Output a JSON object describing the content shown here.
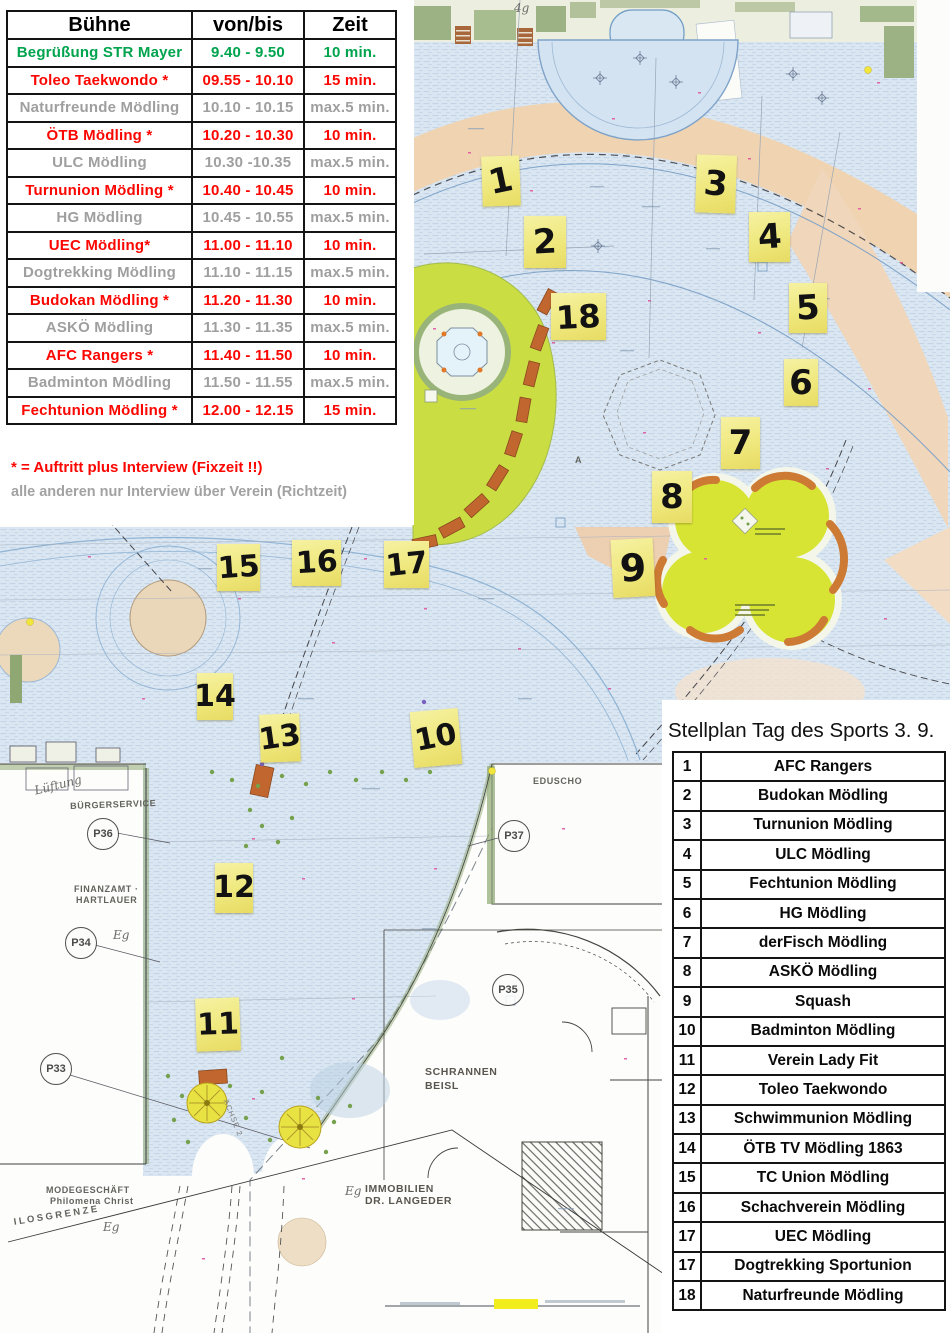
{
  "schedule": {
    "headers": [
      "Bühne",
      "von/bis",
      "Zeit"
    ],
    "rows": [
      {
        "name": "Begrüßung STR Mayer",
        "time": "9.40 - 9.50",
        "dur": "10 min.",
        "c": "green"
      },
      {
        "name": "Toleo Taekwondo *",
        "time": "09.55 - 10.10",
        "dur": "15 min.",
        "c": "red"
      },
      {
        "name": "Naturfreunde Mödling",
        "time": "10.10 - 10.15",
        "dur": "max.5 min.",
        "c": "gray"
      },
      {
        "name": "ÖTB Mödling *",
        "time": "10.20 - 10.30",
        "dur": "10 min.",
        "c": "red"
      },
      {
        "name": "ULC Mödling",
        "time": "10.30 -10.35",
        "dur": "max.5 min.",
        "c": "gray"
      },
      {
        "name": "Turnunion Mödling *",
        "time": "10.40 - 10.45",
        "dur": "10 min.",
        "c": "red"
      },
      {
        "name": "HG Mödling",
        "time": "10.45 - 10.55",
        "dur": "max.5 min.",
        "c": "gray"
      },
      {
        "name": "UEC Mödling*",
        "time": "11.00 - 11.10",
        "dur": "10 min.",
        "c": "red"
      },
      {
        "name": "Dogtrekking Mödling",
        "time": "11.10 - 11.15",
        "dur": "max.5 min.",
        "c": "gray"
      },
      {
        "name": "Budokan Mödling *",
        "time": "11.20 - 11.30",
        "dur": "10 min.",
        "c": "red"
      },
      {
        "name": "ASKÖ Mödling",
        "time": "11.30 - 11.35",
        "dur": "max.5 min.",
        "c": "gray"
      },
      {
        "name": "AFC Rangers *",
        "time": "11.40 - 11.50",
        "dur": "10 min.",
        "c": "red"
      },
      {
        "name": "Badminton Mödling",
        "time": "11.50 - 11.55",
        "dur": "max.5 min.",
        "c": "gray"
      },
      {
        "name": "Fechtunion Mödling *",
        "time": "12.00 - 12.15",
        "dur": "15 min.",
        "c": "red"
      }
    ],
    "footnote_red": "* = Auftritt plus Interview (Fixzeit !!)",
    "footnote_gray": "alle anderen nur Interview über Verein (Richtzeit)"
  },
  "stellplan": {
    "title": "Stellplan Tag des Sports  3. 9.",
    "rows": [
      {
        "num": "1",
        "name": "AFC Rangers"
      },
      {
        "num": "2",
        "name": "Budokan Mödling"
      },
      {
        "num": "3",
        "name": "Turnunion Mödling"
      },
      {
        "num": "4",
        "name": "ULC Mödling"
      },
      {
        "num": "5",
        "name": "Fechtunion Mödling"
      },
      {
        "num": "6",
        "name": "HG Mödling"
      },
      {
        "num": "7",
        "name": "derFisch Mödling"
      },
      {
        "num": "8",
        "name": "ASKÖ Mödling"
      },
      {
        "num": "9",
        "name": "Squash"
      },
      {
        "num": "10",
        "name": "Badminton Mödling"
      },
      {
        "num": "11",
        "name": "Verein Lady Fit"
      },
      {
        "num": "12",
        "name": "Toleo Taekwondo"
      },
      {
        "num": "13",
        "name": "Schwimmunion Mödling"
      },
      {
        "num": "14",
        "name": "ÖTB TV Mödling 1863"
      },
      {
        "num": "15",
        "name": "TC Union Mödling"
      },
      {
        "num": "16",
        "name": "Schachverein Mödling"
      },
      {
        "num": "17",
        "name": "UEC Mödling"
      },
      {
        "num": "17",
        "name": "Dogtrekking Sportunion"
      },
      {
        "num": "18",
        "name": "Naturfreunde Mödling"
      }
    ]
  },
  "map": {
    "colors": {
      "note_yellow": "#f1ea7f",
      "paving_blue": "#dae6f1",
      "path_peach": "#f0d4b2",
      "lawn_green": "#cadd42",
      "playground_green": "#d7e434",
      "brick_orange": "#c1662e",
      "accent_green": "#00a44e",
      "accent_red": "#fb0600",
      "accent_gray": "#9f9f9f"
    },
    "notes": [
      {
        "n": "1",
        "x": 482,
        "y": 156,
        "w": 38,
        "h": 50,
        "tilt": -2,
        "r": -10
      },
      {
        "n": "2",
        "x": 524,
        "y": 216,
        "w": 42,
        "h": 52,
        "tilt": 0,
        "r": -3
      },
      {
        "n": "3",
        "x": 696,
        "y": 155,
        "w": 40,
        "h": 58,
        "tilt": 2,
        "r": 4
      },
      {
        "n": "4",
        "x": 749,
        "y": 212,
        "w": 41,
        "h": 50,
        "tilt": 0,
        "r": -4
      },
      {
        "n": "5",
        "x": 789,
        "y": 283,
        "w": 38,
        "h": 50,
        "tilt": 0,
        "r": -3
      },
      {
        "n": "6",
        "x": 784,
        "y": 359,
        "w": 34,
        "h": 47,
        "tilt": 0,
        "r": 0
      },
      {
        "n": "7",
        "x": 721,
        "y": 417,
        "w": 39,
        "h": 52,
        "tilt": 0,
        "r": 0
      },
      {
        "n": "8",
        "x": 652,
        "y": 471,
        "w": 40,
        "h": 52,
        "tilt": 0,
        "r": 0
      },
      {
        "n": "9",
        "x": 612,
        "y": 539,
        "w": 42,
        "h": 58,
        "tilt": -3,
        "r": 0,
        "fs": 38
      },
      {
        "n": "10",
        "x": 412,
        "y": 710,
        "w": 48,
        "h": 56,
        "tilt": -5,
        "r": -6
      },
      {
        "n": "11",
        "x": 196,
        "y": 998,
        "w": 44,
        "h": 53,
        "tilt": -2,
        "r": 0
      },
      {
        "n": "12",
        "x": 215,
        "y": 863,
        "w": 38,
        "h": 50,
        "tilt": 0,
        "r": 0
      },
      {
        "n": "13",
        "x": 260,
        "y": 714,
        "w": 40,
        "h": 48,
        "tilt": -2,
        "r": -6
      },
      {
        "n": "14",
        "x": 197,
        "y": 673,
        "w": 36,
        "h": 47,
        "tilt": 0,
        "r": 0
      },
      {
        "n": "15",
        "x": 217,
        "y": 544,
        "w": 43,
        "h": 47,
        "tilt": 0,
        "r": -4
      },
      {
        "n": "16",
        "x": 292,
        "y": 540,
        "w": 49,
        "h": 46,
        "tilt": 0,
        "r": -3
      },
      {
        "n": "17",
        "x": 384,
        "y": 541,
        "w": 45,
        "h": 47,
        "tilt": 0,
        "r": -6
      },
      {
        "n": "18",
        "x": 551,
        "y": 293,
        "w": 55,
        "h": 47,
        "tilt": 0,
        "r": -3,
        "fs": 32
      }
    ],
    "labels": [
      {
        "t": "Lüftung",
        "x": 33,
        "y": 784,
        "cls": "hand",
        "r": -14
      },
      {
        "t": "BÜRGERSERVICE",
        "x": 70,
        "y": 801,
        "cls": "plan",
        "r": -2
      },
      {
        "t": "FINANZAMT ·",
        "x": 74,
        "y": 884,
        "cls": "plan",
        "r": 0
      },
      {
        "t": "HARTLAUER",
        "x": 76,
        "y": 895,
        "cls": "plan",
        "r": 0
      },
      {
        "t": "MODEGESCHÄFT",
        "x": 46,
        "y": 1185,
        "cls": "plan",
        "r": 0
      },
      {
        "t": "Philomena Christ",
        "x": 50,
        "y": 1196,
        "cls": "plan",
        "r": 0
      },
      {
        "t": "ILOSGRENZE",
        "x": 13,
        "y": 1217,
        "cls": "sp",
        "r": -9
      },
      {
        "t": "Eg",
        "x": 103,
        "y": 1220,
        "cls": "hand",
        "r": 0
      },
      {
        "t": "Eg",
        "x": 113,
        "y": 928,
        "cls": "hand",
        "r": 0
      },
      {
        "t": "Eg",
        "x": 345,
        "y": 1184,
        "cls": "hand",
        "r": 0
      },
      {
        "t": "SCHRANNEN",
        "x": 425,
        "y": 1066,
        "cls": "big",
        "r": 0
      },
      {
        "t": "BEISL",
        "x": 425,
        "y": 1080,
        "cls": "big",
        "r": 0
      },
      {
        "t": "IMMOBILIEN",
        "x": 365,
        "y": 1183,
        "cls": "big",
        "r": 0
      },
      {
        "t": "DR. LANGEDER",
        "x": 365,
        "y": 1195,
        "cls": "big",
        "r": 0
      },
      {
        "t": "EDUSCHO",
        "x": 533,
        "y": 776,
        "cls": "plan",
        "r": 0
      },
      {
        "t": "4g",
        "x": 514,
        "y": 1,
        "cls": "hand",
        "r": 0
      },
      {
        "t": "A",
        "x": 575,
        "y": 455,
        "cls": "plan",
        "r": 0
      },
      {
        "t": "ACHSE 2",
        "x": 230,
        "y": 1098,
        "cls": "axis",
        "r": 68
      }
    ],
    "parking": [
      {
        "t": "P36",
        "x": 102,
        "y": 833
      },
      {
        "t": "P34",
        "x": 80,
        "y": 942
      },
      {
        "t": "P33",
        "x": 55,
        "y": 1068
      },
      {
        "t": "P37",
        "x": 513,
        "y": 835
      },
      {
        "t": "P35",
        "x": 507,
        "y": 989
      }
    ]
  }
}
